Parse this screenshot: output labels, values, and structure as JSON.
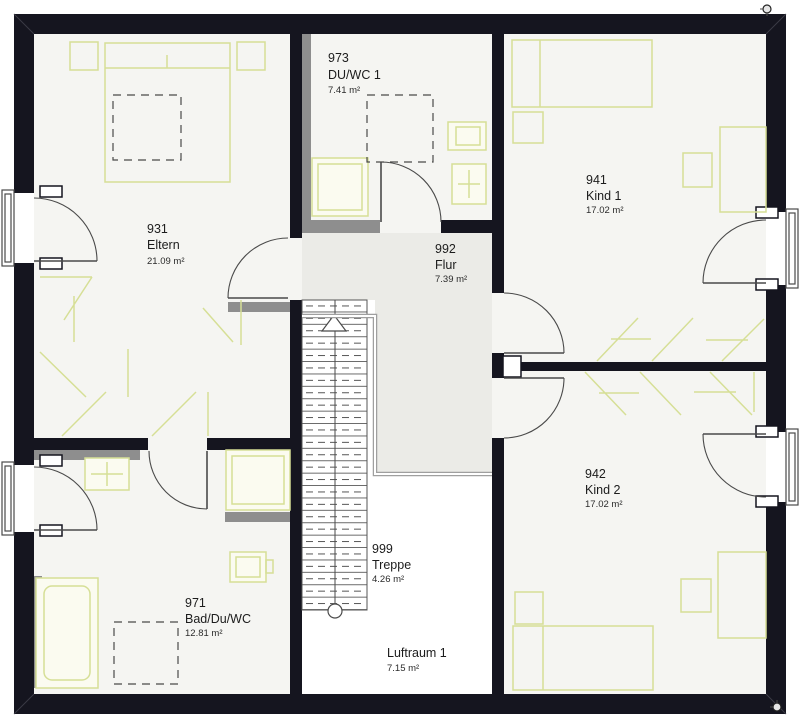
{
  "rooms": [
    {
      "number": "931",
      "name": "Eltern",
      "area": "21.09 m²"
    },
    {
      "number": "973",
      "name": "DU/WC 1",
      "area": "7.41 m²"
    },
    {
      "number": "992",
      "name": "Flur",
      "area": "7.39 m²"
    },
    {
      "number": "941",
      "name": "Kind 1",
      "area": "17.02 m²"
    },
    {
      "number": "942",
      "name": "Kind 2",
      "area": "17.02 m²"
    },
    {
      "number": "971",
      "name": "Bad/Du/WC",
      "area": "12.81 m²"
    },
    {
      "number": "999",
      "name": "Treppe",
      "area": "4.26 m²"
    },
    {
      "name": "Luftraum 1",
      "area": "7.15 m²"
    }
  ],
  "colors": {
    "wall": "#15151f",
    "knee": "#8e8e8e",
    "furniture": "#d6df96",
    "fixture_fill": "#fbfbf0",
    "floor": "#f5f5f2",
    "flur_floor": "#ebebe7",
    "void_floor": "#ffffff",
    "outline": "#4a4a4a",
    "railing": "#9f9f9f"
  }
}
